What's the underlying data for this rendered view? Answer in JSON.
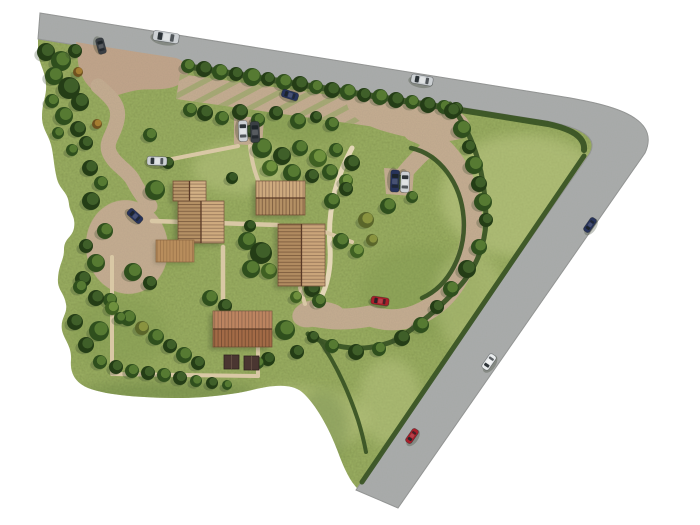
{
  "scene": {
    "canvas": {
      "width": 700,
      "height": 525,
      "background": "#ffffff"
    },
    "colors": {
      "background": "#ffffff",
      "grass": "#9db163",
      "grass_dark": "#7f974e",
      "grass_light": "#bdc885",
      "grass_shadow": "#5f7a3e",
      "road": "#a6a8a7",
      "road_edge": "#8b8d8c",
      "gravel": "#c6ae92",
      "apron": "#c2a58b",
      "path": "#d9c8a5",
      "path_light": "#e4d7b7",
      "hedge": "#3a5425",
      "tree_shadow": "#35482a",
      "deck": "#b88d5c",
      "bed": "#4a3631"
    },
    "site": {
      "outline": "M 38,39 L 552,122 C 578,126 602,133 598,152 L 358,489 C 352,483 346,474 338,452 C 330,430 316,404 302,392 C 290,382 268,386 252,390 C 236,394 206,398 178,398 C 148,398 108,396 88,388 C 74,382 70,372 71,360 C 72,346 64,340 62,330 C 60,318 68,314 66,304 C 64,292 57,290 58,278 C 59,264 64,260 64,250 C 64,238 72,238 74,228 C 76,216 70,214 69,204 C 68,192 60,190 57,179 C 54,166 54,160 52,149 C 50,136 42,130 42,117 C 42,102 47,96 46,84 C 45,70 39,64 38,52 Z"
    },
    "road": {
      "outline": "M 40,13 L 552,95 C 610,104 662,116 645,153 L 398,508 L 356,490 L 590,153 C 600,134 572,127 552,122 L 38,39 Z"
    },
    "grass_patches": [
      [
        300,
        120,
        55,
        24,
        "grass_dark",
        0.35
      ],
      [
        240,
        168,
        48,
        26,
        "grass_light",
        0.45
      ],
      [
        160,
        240,
        40,
        28,
        "grass_dark",
        0.3
      ],
      [
        420,
        292,
        60,
        46,
        "grass_dark",
        0.35
      ],
      [
        525,
        196,
        85,
        62,
        "grass_light",
        0.55
      ],
      [
        470,
        300,
        36,
        50,
        "grass_light",
        0.4
      ],
      [
        300,
        420,
        68,
        34,
        "grass_light",
        0.5
      ],
      [
        120,
        332,
        48,
        36,
        "grass_dark",
        0.35
      ],
      [
        390,
        402,
        32,
        44,
        "grass_light",
        0.45
      ],
      [
        170,
        392,
        88,
        10,
        "grass_shadow",
        0.4
      ],
      [
        322,
        428,
        26,
        38,
        "grass_shadow",
        0.3
      ]
    ],
    "gravel": {
      "fills": [
        {
          "name": "entrance-apron",
          "c": "apron",
          "d": "M 76,42 C 110,48 145,53 176,58 C 190,63 192,76 180,84 C 166,92 150,88 138,90 C 124,92 116,98 104,95 C 90,92 80,78 78,62 Z"
        },
        {
          "name": "parking-strip",
          "d": "M 180,74 L 408,106 L 404,131 L 176,99 Z",
          "stripes": true
        },
        {
          "name": "parking-nook",
          "d": "M 234,116 L 264,118 L 262,146 L 234,144 Z"
        },
        {
          "name": "upper-pad",
          "d": "M 348,94 L 448,108 C 466,112 474,124 468,134 C 458,144 432,142 412,138 C 392,134 368,128 356,118 C 348,112 344,100 348,94 Z"
        },
        {
          "name": "car-pad",
          "d": "M 384,168 L 414,170 L 412,196 L 386,194 Z"
        },
        {
          "name": "south-pad",
          "d": "M 300,304 Q 330,298 342,308 Q 346,320 332,326 Q 312,330 300,322 Z"
        }
      ],
      "strokes": [
        {
          "name": "west-drive",
          "w": 15,
          "d": "M 98,86 C 112,98 120,106 117,120 C 114,136 104,142 110,154 C 116,166 128,170 134,182 C 140,194 146,200 150,206"
        },
        {
          "name": "west-spur",
          "w": 18,
          "d": "M 120,160 L 172,160"
        },
        {
          "name": "branch-drive",
          "w": 16,
          "d": "M 436,142 Q 416,158 402,176"
        },
        {
          "name": "loop-drive",
          "w": 21,
          "d": "M 414,131 A 78,94 0 1 1 370,316 Q 340,322 314,316"
        }
      ],
      "ellipses": [
        [
          127,
          247,
          41,
          47,
          -8,
          "turning-bulb"
        ],
        [
          310,
          314,
          18,
          13,
          -15,
          "drive-end-pad"
        ]
      ]
    },
    "paths": [
      {
        "name": "light-garden-path",
        "c": "path_light",
        "w": 5,
        "d": "M 352,148 Q 326,196 330,248 Q 332,282 316,306"
      },
      {
        "name": "footpath",
        "w": 4.5,
        "d": "M 152,221 L 278,225"
      },
      {
        "name": "footpath",
        "w": 4.5,
        "d": "M 223,247 L 223,311"
      },
      {
        "name": "footpath",
        "w": 4,
        "d": "M 112,257 L 112,372"
      },
      {
        "name": "footpath",
        "w": 4,
        "d": "M 112,374 L 258,376"
      },
      {
        "name": "footpath",
        "w": 4,
        "d": "M 258,340 L 258,376"
      },
      {
        "name": "footpath",
        "w": 4,
        "d": "M 325,232 L 352,242"
      },
      {
        "name": "footpath",
        "w": 4,
        "d": "M 300,288 L 305,304"
      },
      {
        "name": "footpath",
        "w": 4,
        "d": "M 250,146 Q 252,165 258,180"
      },
      {
        "name": "footpath",
        "w": 4,
        "d": "M 172,159 L 238,146"
      }
    ],
    "hedges": [
      {
        "name": "north-hedge",
        "w": 6,
        "d": "M 185,66 L 548,124 Q 586,132 584,150"
      },
      {
        "name": "southeast-hedge",
        "w": 5,
        "d": "M 584,156 L 362,482"
      },
      {
        "name": "paddock-hedge",
        "w": 5,
        "d": "M 450,104 Q 486,150 486,222 Q 484,260 458,288 Q 430,318 396,340 Q 364,354 330,344 Q 316,340 308,334"
      },
      {
        "name": "garden-inner-hedge",
        "w": 4.5,
        "d": "M 411,148 A 64,78 0 0 1 422,298"
      },
      {
        "name": "south-strip-hedge",
        "w": 4,
        "d": "M 318,338 Q 342,372 358,420 Q 363,436 366,452"
      }
    ],
    "tree_palettes": {
      "dark": [
        "#243d16",
        "#41612a"
      ],
      "mid": [
        "#2f4f1d",
        "#587c34"
      ],
      "light": [
        "#3f6022",
        "#71923f"
      ],
      "olive": [
        "#5a662a",
        "#8c9640"
      ],
      "autumn": [
        "#6e511f",
        "#a87f33"
      ],
      "bush": [
        "#223c14",
        "#3a5a26"
      ]
    },
    "trees": [
      [
        188,
        66,
        7,
        "mid"
      ],
      [
        204,
        69,
        8,
        "dark"
      ],
      [
        220,
        72,
        8,
        "mid"
      ],
      [
        236,
        74,
        7,
        "dark"
      ],
      [
        252,
        77,
        9,
        "mid"
      ],
      [
        268,
        79,
        7,
        "dark"
      ],
      [
        284,
        82,
        8,
        "mid"
      ],
      [
        300,
        84,
        8,
        "dark"
      ],
      [
        316,
        87,
        7,
        "mid"
      ],
      [
        332,
        90,
        8,
        "dark"
      ],
      [
        348,
        92,
        8,
        "mid"
      ],
      [
        364,
        95,
        7,
        "dark"
      ],
      [
        380,
        97,
        8,
        "mid"
      ],
      [
        396,
        100,
        8,
        "dark"
      ],
      [
        412,
        102,
        7,
        "mid"
      ],
      [
        428,
        105,
        8,
        "dark"
      ],
      [
        444,
        107,
        7,
        "mid"
      ],
      [
        456,
        109,
        7,
        "dark"
      ],
      [
        46,
        52,
        9,
        "dark"
      ],
      [
        61,
        61,
        10,
        "mid"
      ],
      [
        75,
        51,
        7,
        "dark"
      ],
      [
        54,
        76,
        9,
        "mid"
      ],
      [
        69,
        88,
        11,
        "dark"
      ],
      [
        52,
        101,
        7,
        "mid"
      ],
      [
        80,
        102,
        9,
        "dark"
      ],
      [
        64,
        116,
        9,
        "mid"
      ],
      [
        78,
        129,
        8,
        "dark"
      ],
      [
        58,
        133,
        6,
        "mid"
      ],
      [
        86,
        143,
        7,
        "dark"
      ],
      [
        72,
        150,
        6,
        "mid"
      ],
      [
        78,
        72,
        5,
        "autumn"
      ],
      [
        97,
        124,
        5,
        "autumn"
      ],
      [
        190,
        110,
        7,
        "mid"
      ],
      [
        205,
        113,
        8,
        "dark"
      ],
      [
        222,
        118,
        7,
        "mid"
      ],
      [
        240,
        112,
        8,
        "dark"
      ],
      [
        258,
        120,
        7,
        "mid"
      ],
      [
        276,
        113,
        7,
        "dark"
      ],
      [
        298,
        121,
        8,
        "mid"
      ],
      [
        316,
        117,
        6,
        "dark"
      ],
      [
        332,
        124,
        7,
        "mid"
      ],
      [
        250,
        131,
        6,
        "bush"
      ],
      [
        262,
        148,
        10,
        "mid"
      ],
      [
        282,
        156,
        9,
        "dark"
      ],
      [
        300,
        148,
        8,
        "mid"
      ],
      [
        318,
        158,
        9,
        "light"
      ],
      [
        336,
        150,
        7,
        "mid"
      ],
      [
        352,
        163,
        8,
        "dark"
      ],
      [
        270,
        168,
        8,
        "light"
      ],
      [
        292,
        173,
        9,
        "mid"
      ],
      [
        312,
        176,
        7,
        "dark"
      ],
      [
        330,
        172,
        8,
        "mid"
      ],
      [
        346,
        181,
        7,
        "light"
      ],
      [
        452,
        111,
        8,
        "dark"
      ],
      [
        462,
        129,
        9,
        "mid"
      ],
      [
        469,
        147,
        7,
        "dark"
      ],
      [
        474,
        165,
        9,
        "mid"
      ],
      [
        479,
        184,
        8,
        "dark"
      ],
      [
        483,
        202,
        9,
        "mid"
      ],
      [
        486,
        220,
        7,
        "dark"
      ],
      [
        479,
        247,
        8,
        "mid"
      ],
      [
        467,
        269,
        9,
        "dark"
      ],
      [
        451,
        289,
        8,
        "mid"
      ],
      [
        437,
        307,
        7,
        "dark"
      ],
      [
        421,
        325,
        8,
        "mid"
      ],
      [
        402,
        338,
        8,
        "dark"
      ],
      [
        379,
        349,
        7,
        "mid"
      ],
      [
        356,
        352,
        8,
        "dark"
      ],
      [
        332,
        346,
        7,
        "mid"
      ],
      [
        313,
        337,
        6,
        "dark"
      ],
      [
        232,
        178,
        6,
        "bush"
      ],
      [
        250,
        226,
        6,
        "bush"
      ],
      [
        247,
        241,
        9,
        "mid"
      ],
      [
        261,
        253,
        11,
        "dark"
      ],
      [
        251,
        269,
        9,
        "mid"
      ],
      [
        269,
        271,
        8,
        "light"
      ],
      [
        300,
        273,
        9,
        "mid"
      ],
      [
        312,
        289,
        8,
        "dark"
      ],
      [
        319,
        301,
        7,
        "mid"
      ],
      [
        296,
        297,
        6,
        "light"
      ],
      [
        341,
        241,
        8,
        "mid"
      ],
      [
        357,
        251,
        7,
        "light"
      ],
      [
        366,
        220,
        8,
        "olive"
      ],
      [
        372,
        240,
        6,
        "olive"
      ],
      [
        388,
        206,
        8,
        "mid"
      ],
      [
        400,
        182,
        7,
        "light"
      ],
      [
        412,
        197,
        6,
        "mid"
      ],
      [
        332,
        201,
        8,
        "mid"
      ],
      [
        346,
        189,
        7,
        "dark"
      ],
      [
        155,
        190,
        10,
        "mid"
      ],
      [
        168,
        163,
        6,
        "dark"
      ],
      [
        150,
        135,
        7,
        "mid"
      ],
      [
        90,
        168,
        8,
        "dark"
      ],
      [
        101,
        183,
        7,
        "mid"
      ],
      [
        91,
        201,
        9,
        "dark"
      ],
      [
        105,
        231,
        8,
        "mid"
      ],
      [
        86,
        246,
        7,
        "dark"
      ],
      [
        96,
        263,
        9,
        "mid"
      ],
      [
        83,
        279,
        8,
        "dark"
      ],
      [
        133,
        272,
        9,
        "mid"
      ],
      [
        150,
        283,
        7,
        "dark"
      ],
      [
        210,
        298,
        8,
        "mid"
      ],
      [
        225,
        306,
        7,
        "dark"
      ],
      [
        285,
        330,
        10,
        "mid"
      ],
      [
        297,
        352,
        7,
        "dark"
      ],
      [
        268,
        359,
        7,
        "bush"
      ],
      [
        258,
        363,
        6,
        "mid"
      ],
      [
        75,
        322,
        8,
        "dark"
      ],
      [
        99,
        331,
        10,
        "mid"
      ],
      [
        86,
        345,
        8,
        "dark"
      ],
      [
        110,
        300,
        7,
        "mid"
      ],
      [
        80,
        287,
        7,
        "mid"
      ],
      [
        96,
        298,
        8,
        "dark"
      ],
      [
        112,
        308,
        7,
        "light"
      ],
      [
        128,
        318,
        8,
        "mid"
      ],
      [
        142,
        328,
        7,
        "olive"
      ],
      [
        156,
        337,
        8,
        "mid"
      ],
      [
        170,
        346,
        7,
        "dark"
      ],
      [
        184,
        355,
        8,
        "mid"
      ],
      [
        198,
        363,
        7,
        "dark"
      ],
      [
        120,
        318,
        6,
        "mid"
      ],
      [
        100,
        362,
        7,
        "mid"
      ],
      [
        116,
        367,
        7,
        "dark"
      ],
      [
        132,
        371,
        7,
        "mid"
      ],
      [
        148,
        373,
        7,
        "dark"
      ],
      [
        164,
        375,
        7,
        "mid"
      ],
      [
        180,
        378,
        7,
        "dark"
      ],
      [
        196,
        381,
        6,
        "mid"
      ],
      [
        212,
        383,
        6,
        "dark"
      ],
      [
        227,
        385,
        5,
        "mid"
      ]
    ],
    "buildings": [
      {
        "name": "house-a-wing",
        "x": 173,
        "y": 181,
        "w": 33,
        "h": 20,
        "ridge": "v",
        "base": "#cda776"
      },
      {
        "name": "house-a-main",
        "x": 178,
        "y": 201,
        "w": 46,
        "h": 42,
        "ridge": "v",
        "base": "#c9a170"
      },
      {
        "name": "house-b",
        "x": 256,
        "y": 181,
        "w": 49,
        "h": 34,
        "ridge": "h",
        "base": "#c9a170"
      },
      {
        "name": "house-c",
        "x": 278,
        "y": 224,
        "w": 47,
        "h": 62,
        "ridge": "v",
        "base": "#c59b6b"
      },
      {
        "name": "house-d",
        "x": 213,
        "y": 311,
        "w": 59,
        "h": 36,
        "ridge": "h",
        "base": "#b6774e"
      }
    ],
    "deck": {
      "x": 156,
      "y": 240,
      "w": 38,
      "h": 22
    },
    "beds": [
      [
        224,
        355,
        15,
        14
      ],
      [
        244,
        356,
        15,
        14
      ]
    ],
    "car_colors": {
      "silver": "#ccd0d3",
      "darkgray": "#3a3f44",
      "darkblue": "#27335b",
      "red": "#a81f2a",
      "white": "#e9eced",
      "window": "#1c2227"
    },
    "cars": [
      [
        166,
        37,
        26,
        10,
        9,
        "silver"
      ],
      [
        422,
        80,
        22,
        9,
        10,
        "silver"
      ],
      [
        101,
        46,
        16,
        8,
        75,
        "darkgray"
      ],
      [
        290,
        95,
        17,
        8,
        18,
        "darkblue"
      ],
      [
        243,
        131,
        21,
        9,
        88,
        "silver"
      ],
      [
        255,
        132,
        21,
        9,
        88,
        "darkgray"
      ],
      [
        157,
        161,
        20,
        9,
        2,
        "silver"
      ],
      [
        135,
        216,
        17,
        8,
        42,
        "darkblue"
      ],
      [
        395,
        181,
        22,
        9,
        92,
        "darkblue"
      ],
      [
        405,
        182,
        21,
        9,
        92,
        "silver"
      ],
      [
        380,
        301,
        18,
        8,
        8,
        "red"
      ],
      [
        590,
        225,
        16,
        7,
        -55,
        "darkblue"
      ],
      [
        489,
        362,
        17,
        8,
        -55,
        "white"
      ],
      [
        412,
        436,
        16,
        7,
        -55,
        "red"
      ]
    ]
  }
}
